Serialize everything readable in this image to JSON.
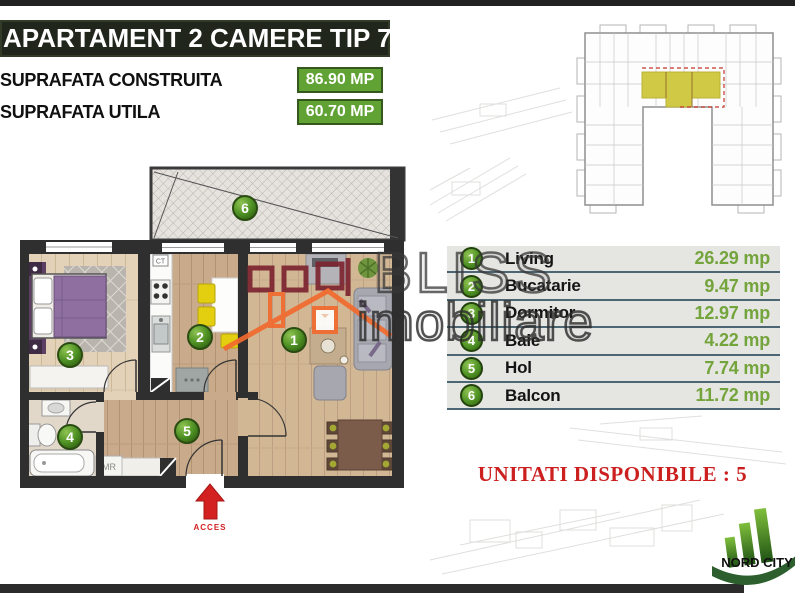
{
  "colors": {
    "accent_green": "#61a234",
    "value_green": "#74a43c",
    "circle_green": "#4f9224",
    "alert_red": "#cc2020",
    "highlight_yellow": "#cfc945",
    "wall_dark": "#2f2f2f",
    "watermark_orange": "#f26a2e"
  },
  "header": {
    "title": "APARTAMENT 2 CAMERE TIP 7",
    "surface_built_label": "SUPRAFATA CONSTRUITA",
    "surface_built_value": "86.90 MP",
    "surface_useful_label": "SUPRAFATA UTILA",
    "surface_useful_value": "60.70 MP"
  },
  "legend": {
    "rooms": [
      {
        "num": "1",
        "name": "Living",
        "area": "26.29 mp"
      },
      {
        "num": "2",
        "name": "Bucatarie",
        "area": "9.47 mp"
      },
      {
        "num": "3",
        "name": "Dormitor",
        "area": "12.97 mp"
      },
      {
        "num": "4",
        "name": "Baie",
        "area": "4.22 mp"
      },
      {
        "num": "5",
        "name": "Hol",
        "area": "7.74 mp"
      },
      {
        "num": "6",
        "name": "Balcon",
        "area": "11.72 mp"
      }
    ]
  },
  "floor_plan": {
    "access_label": "ACCES",
    "washing_machine_label": "MR",
    "boiler_label": "CT"
  },
  "availability": {
    "text": "UNITATI DISPONIBILE : 5"
  },
  "watermark": {
    "brand": "BLISS",
    "brand2": "imobiliare"
  },
  "developer_logo": {
    "name": "NORD CITY"
  }
}
